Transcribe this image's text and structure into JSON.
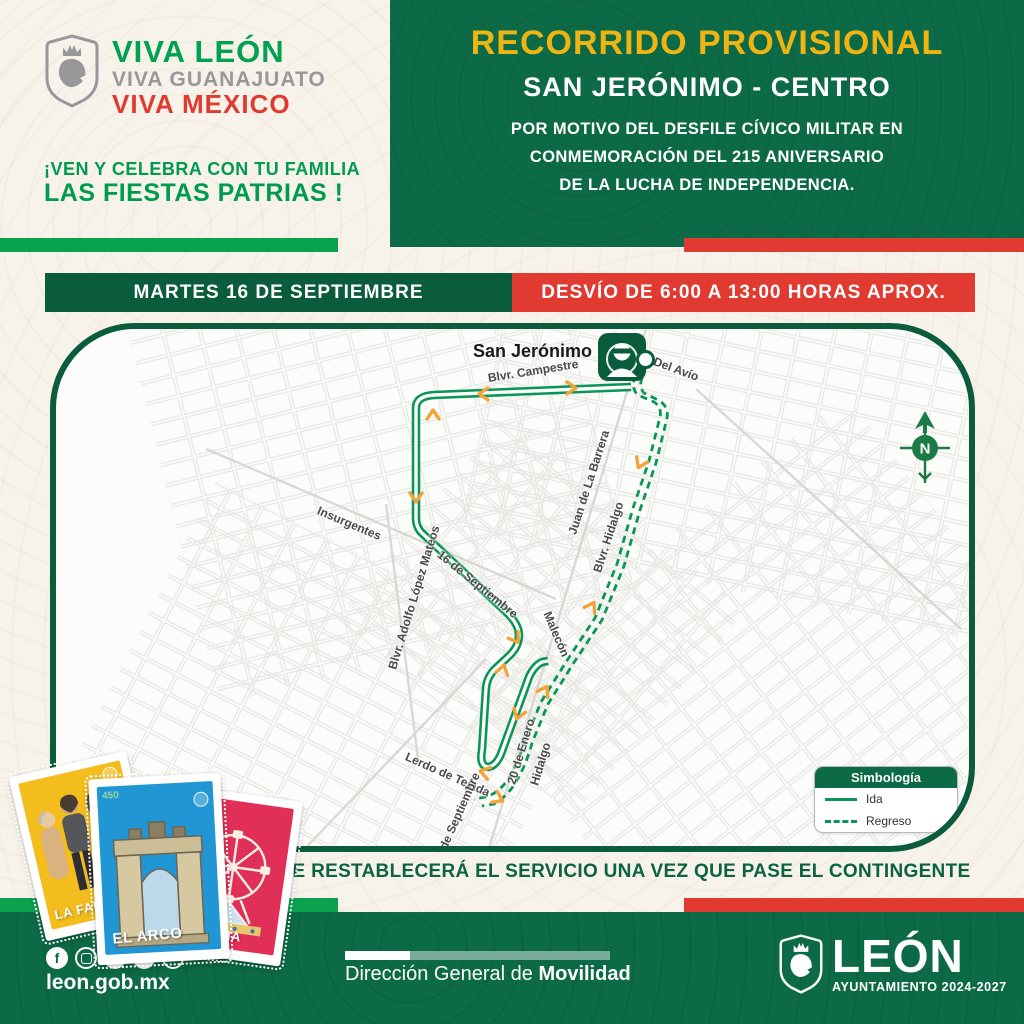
{
  "brand": {
    "viva_leon": "VIVA LEÓN",
    "viva_guanajuato": "VIVA GUANAJUATO",
    "viva_mexico": "VIVA MÉXICO"
  },
  "invite": {
    "line1": "¡VEN Y CELEBRA CON TU FAMILIA",
    "line2": "LAS FIESTAS PATRIAS !"
  },
  "panel": {
    "title": "RECORRIDO PROVISIONAL",
    "route": "SAN JERÓNIMO - CENTRO",
    "reason1": "POR MOTIVO DEL DESFILE CÍVICO MILITAR EN",
    "reason2": "CONMEMORACIÓN DEL 215 ANIVERSARIO",
    "reason3": "DE LA LUCHA DE INDEPENDENCIA."
  },
  "banners": {
    "date": "MARTES 16 DE SEPTIEMBRE",
    "detour": "DESVÍO DE 6:00 A 13:00 HORAS APROX."
  },
  "map": {
    "origin": "San Jerónimo",
    "compass_letter": "N",
    "streets": [
      {
        "label": "Blvr. Campestre",
        "x": 432,
        "y": 42,
        "rot": -9
      },
      {
        "label": "Del Avío",
        "x": 598,
        "y": 25,
        "rot": 20
      },
      {
        "label": "Insurgentes",
        "x": 262,
        "y": 174,
        "rot": 23
      },
      {
        "label": "16 de Septiembre",
        "x": 383,
        "y": 217,
        "rot": 39
      },
      {
        "label": "Blvr. Adolfo López Mateos",
        "x": 336,
        "y": 333,
        "rot": -73
      },
      {
        "label": "Juan de La Barrera",
        "x": 516,
        "y": 198,
        "rot": -72
      },
      {
        "label": "Blvr. Hidalgo",
        "x": 541,
        "y": 236,
        "rot": -72
      },
      {
        "label": "Malecón",
        "x": 491,
        "y": 276,
        "rot": 67
      },
      {
        "label": "Lerdo de Tejada",
        "x": 350,
        "y": 420,
        "rot": 24
      },
      {
        "label": "20 de Enero",
        "x": 455,
        "y": 448,
        "rot": -73
      },
      {
        "label": "Hidalgo",
        "x": 478,
        "y": 449,
        "rot": -73
      },
      {
        "label": "27 de Septiembre",
        "x": 380,
        "y": 528,
        "rot": -66
      }
    ],
    "legend": {
      "title": "Simbología",
      "ida": "Ida",
      "regreso": "Regreso"
    }
  },
  "notice": "SE RESTABLECERÁ EL SERVICIO UNA VEZ QUE PASE EL CONTINGENTE",
  "cards": [
    {
      "label": "LA FAMILIA"
    },
    {
      "label": "EL ARCO",
      "number": "450"
    },
    {
      "label": "LA FERIA"
    }
  ],
  "footer": {
    "website": "leon.gob.mx",
    "social": [
      "facebook",
      "instagram",
      "x",
      "tiktok",
      "youtube"
    ],
    "dept_regular": "Dirección General de ",
    "dept_bold": "Movilidad",
    "city": "LEÓN",
    "term": "AYUNTAMIENTO 2024-2027"
  },
  "colors": {
    "dark_green": "#0a5c3c",
    "panel_green": "#0d6a46",
    "bright_green": "#0aa14f",
    "red": "#e13a30",
    "gold": "#eeb414",
    "route_green": "#089658",
    "arrow_orange": "#f2a43b",
    "cream": "#f7f3ea"
  }
}
